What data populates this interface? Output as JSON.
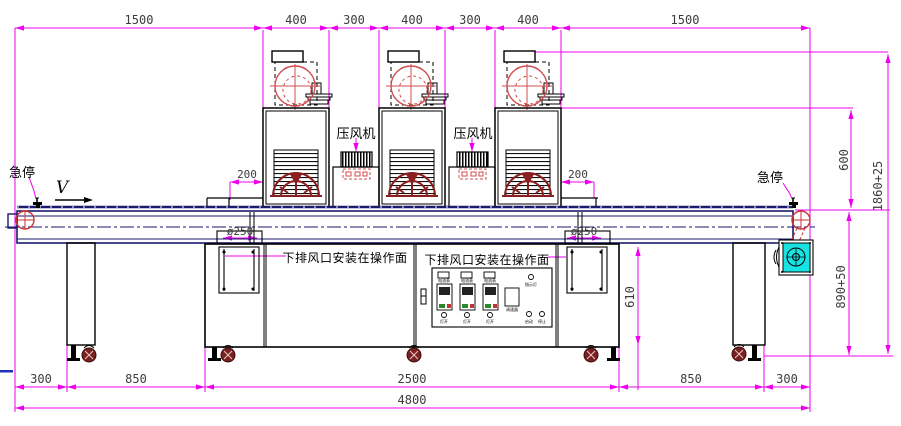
{
  "dimensions": {
    "top": [
      "1500",
      "400",
      "300",
      "400",
      "300",
      "400",
      "1500"
    ],
    "gap_left": "200",
    "gap_right": "200",
    "duct_left": "ø250",
    "duct_right": "ø250",
    "height_hood": "600",
    "height_overall": "1860+25",
    "height_belt": "890+50",
    "height_cabinet": "610",
    "bottom": [
      "300",
      "850",
      "2500",
      "850",
      "300"
    ],
    "total_length": "4800"
  },
  "labels": {
    "estop_left": "急停",
    "estop_right": "急停",
    "direction": "V",
    "blower_left": "压风机",
    "blower_right": "压风机",
    "exhaust_left": "下排风口安装在操作面",
    "exhaust_right": "下排风口安装在操作面"
  },
  "control_panel": {
    "meters": [
      "电流表",
      "电流表",
      "电流表"
    ],
    "lamp_switches": [
      "灯开",
      "灯开",
      "灯开"
    ],
    "speed_knob": "调速器",
    "indicator": "指示灯",
    "start": "启动",
    "stop": "停止"
  },
  "colors": {
    "dimension": "#ee00ee",
    "conveyor": "#1a1a6e",
    "blower_red": "#d24d4d",
    "fan_dark_red": "#8b1e1e",
    "motor_cyan": "#17e3e3",
    "caster": "#7b2020"
  }
}
